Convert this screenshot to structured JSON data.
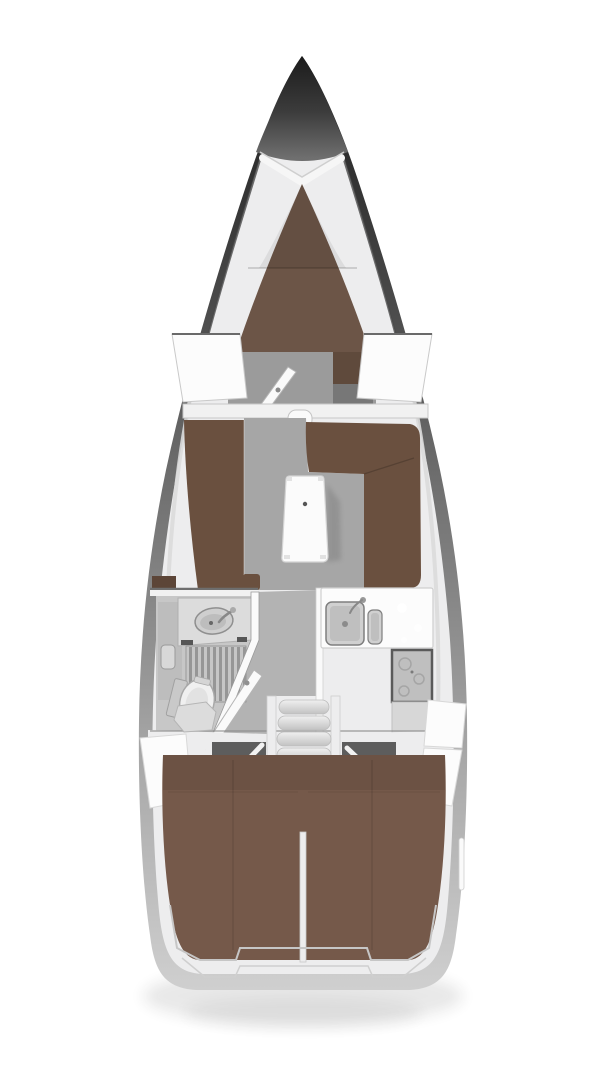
{
  "meta": {
    "title": "Sailing yacht interior layout — top-view deck plan",
    "type": "floor-plan",
    "background": "#ffffff"
  },
  "colors": {
    "background": "#ffffff",
    "hull_dark": "#1f1f1f",
    "hull_mid": "#6e6e6e",
    "hull_light": "#cccccc",
    "deck": "#ededee",
    "deck_bright": "#fafafa",
    "panel_white": "#fcfcfc",
    "bulkhead": "#f1f1f1",
    "floor": "#a6a6a6",
    "fwd_floor": "#9b9b9b",
    "corridor": "#b3b3b3",
    "head_floor": "#c7c7c7",
    "vberth": "#6c5547",
    "settee": "#6a503f",
    "aft_berth": "#75594a",
    "wardrobe": "#5f4a3c",
    "locker_brown": "#5c4537",
    "engine": "#4b4b4b",
    "footwell": "#5d5d5d",
    "cabinet_gray": "#777777",
    "table": "#fbfbfb",
    "step": "#dcdcdc",
    "stove": "#bfbfbf",
    "stove_frame": "#5a5a5a",
    "sink_metal": "#d0d0d0",
    "basin": "#cfcfcf",
    "grate_bg": "#c6c6c6",
    "grate_slat": "#969696",
    "toilet_white": "#f0f0f0",
    "counter": "#dcdcdc",
    "fitting_dark": "#3d3d3d"
  },
  "regions": {
    "bow": "Bow",
    "v_berth": "Forward cabin V-berth",
    "forward_wardrobe": "Forward cabin wardrobe",
    "forward_cabin_floor": "Forward cabin sole",
    "forward_cabin_door": "Forward cabin door (open)",
    "main_bulkhead": "Main bulkhead",
    "port_settee": "Saloon port settee",
    "starboard_settee": "Saloon starboard L-settee",
    "saloon_table": "Saloon table",
    "saloon_floor": "Saloon sole",
    "head": "Head (wet bathroom)",
    "washbasin": "Washbasin",
    "shower_grate": "Shower floor grate",
    "toilet": "Marine toilet",
    "head_door": "Head door (open)",
    "galley": "L-shaped galley",
    "galley_sink": "Galley double sink",
    "stove": "Gimbaled stove / oven",
    "companionway": "Companionway steps",
    "engine_compartment": "Engine compartment",
    "aft_berth_port": "Aft cabin berth (port)",
    "aft_berth_starboard": "Aft cabin berth (starboard)",
    "cockpit_lockers": "Cockpit side lockers",
    "stern": "Stern / transom"
  }
}
